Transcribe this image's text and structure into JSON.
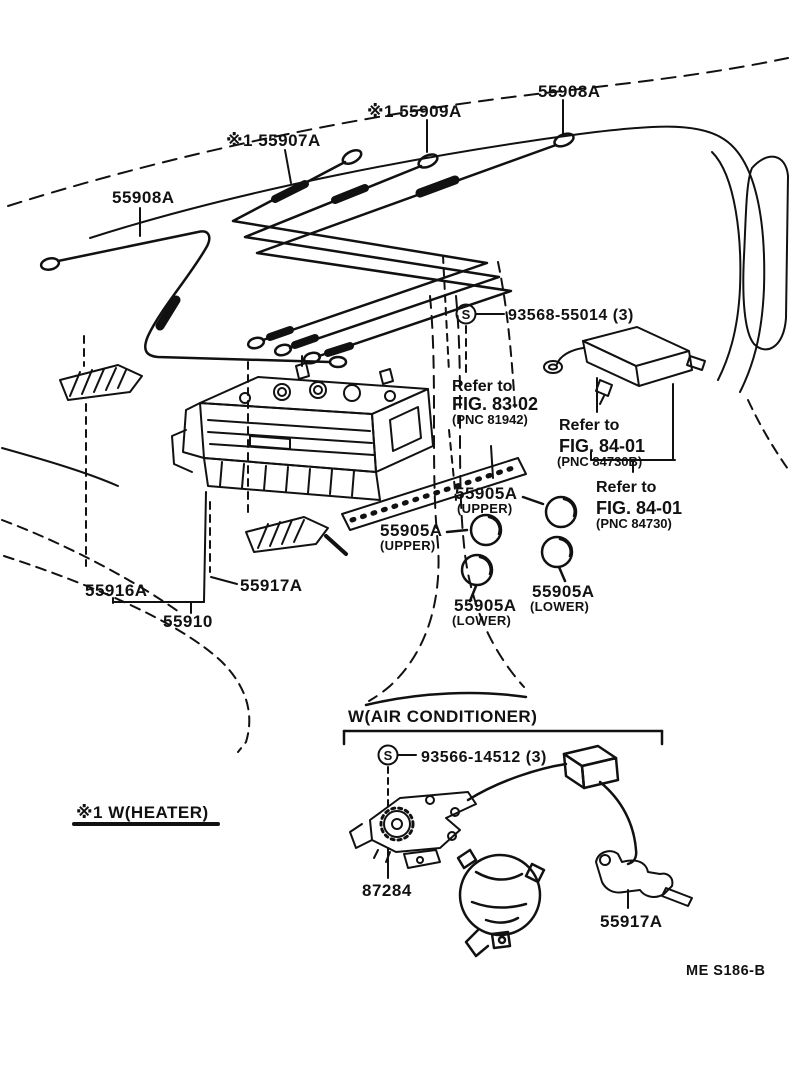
{
  "diagram": {
    "title_section_ac": "W(AIR  CONDITIONER)",
    "note_heater": "※1 W(HEATER)",
    "page_code": "ME S186-B",
    "callouts": {
      "cable_55907a": "※1 55907A",
      "cable_55909a": "※1 55909A",
      "cable_55908a_top": "55908A",
      "cable_55908a_left": "55908A",
      "screw_top_symbol": "S",
      "screw_top": "93568-55014 (3)",
      "screw_bottom_symbol": "S",
      "screw_bottom": "93566-14512 (3)",
      "knob_upper_right": "55905A",
      "knob_upper_right_note": "(UPPER)",
      "knob_upper_left": "55905A",
      "knob_upper_left_note": "(UPPER)",
      "knob_lower_left": "55905A",
      "knob_lower_left_note": "(LOWER)",
      "knob_lower_right": "55905A",
      "knob_lower_right_note": "(LOWER)",
      "lever_55916a": "55916A",
      "lever_55917a": "55917A",
      "control_55910": "55910",
      "servo_87284": "87284",
      "bracket_55917a": "55917A"
    },
    "references": {
      "ref1": {
        "line1": "Refer to",
        "line2": "FIG. 83-02",
        "line3": "(PNC 81942)"
      },
      "ref2": {
        "line1": "Refer to",
        "line2": "FIG. 84-01",
        "line3": "(PNC 84730B)"
      },
      "ref3": {
        "line1": "Refer to",
        "line2": "FIG. 84-01",
        "line3": "(PNC 84730)"
      }
    },
    "colors": {
      "ink": "#111111",
      "background": "#ffffff"
    }
  }
}
